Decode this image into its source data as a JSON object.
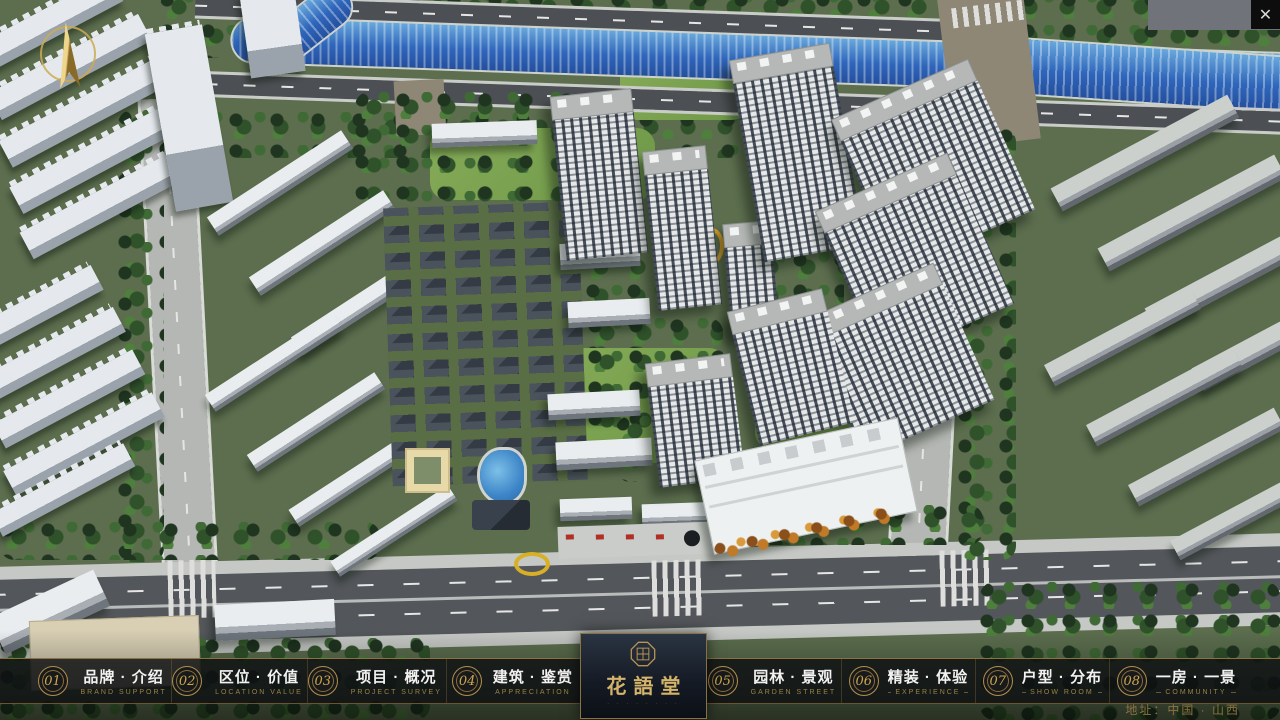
{
  "window": {
    "close_label": "✕"
  },
  "navbar": {
    "items": [
      {
        "num": "01",
        "zh": "品牌 · 介绍",
        "en": "BRAND SUPPORT"
      },
      {
        "num": "02",
        "zh": "区位 · 价值",
        "en": "LOCATION VALUE"
      },
      {
        "num": "03",
        "zh": "项目 · 概况",
        "en": "PROJECT SURVEY"
      },
      {
        "num": "04",
        "zh": "建筑 · 鉴赏",
        "en": "APPRECIATION"
      },
      {
        "num": "05",
        "zh": "园林 · 景观",
        "en": "GARDEN STREET"
      },
      {
        "num": "06",
        "zh": "精装 · 体验",
        "en": "EXPERIENCE"
      },
      {
        "num": "07",
        "zh": "户型 · 分布",
        "en": "SHOW ROOM"
      },
      {
        "num": "08",
        "zh": "一房 · 一景",
        "en": "COMMUNITY"
      }
    ]
  },
  "logo": {
    "title": "花語堂",
    "subtitle": "· · · · · · · ·"
  },
  "footer": {
    "address": "地址：中国 · 山西"
  },
  "colors": {
    "gold": "#c9a54e",
    "navbar_bg": "rgba(14,16,18,0.82)",
    "river_blue": "#2f66bb",
    "tree_green": "#30522b"
  }
}
